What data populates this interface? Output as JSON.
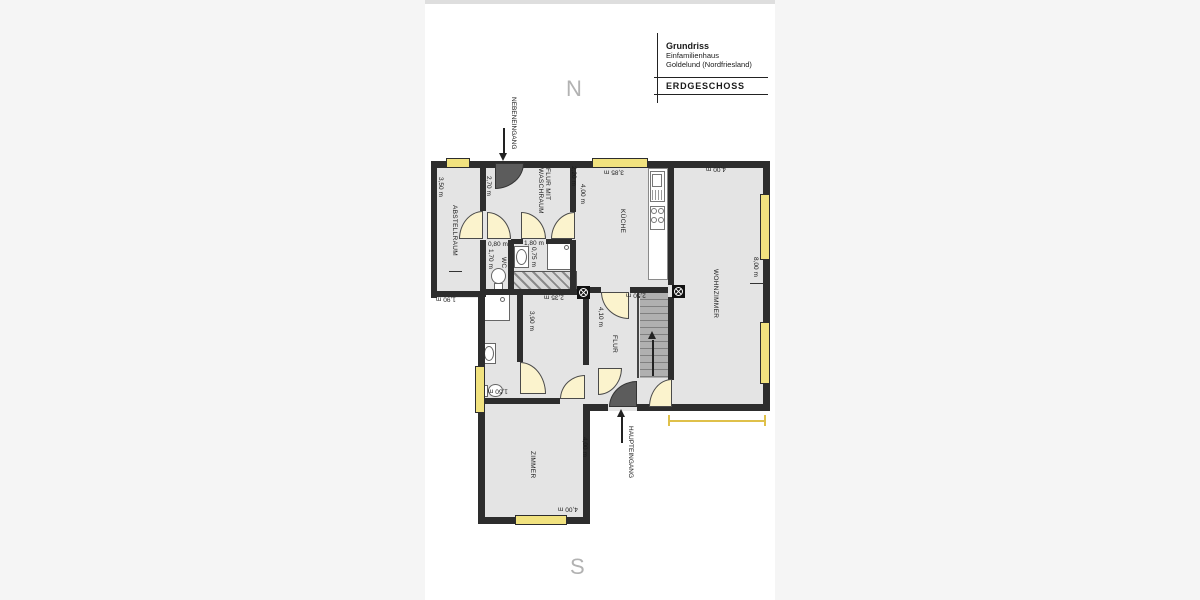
{
  "title_block": {
    "title": "Grundriss",
    "subtitle1": "Einfamilienhaus",
    "subtitle2": "Goldelund (Nordfriesland)",
    "floor_label": "ERDGESCHOSS"
  },
  "compass": {
    "north": "N",
    "south": "S"
  },
  "entrances": {
    "side_entrance": "NEBENEINGANG",
    "main_entrance": "HAUPTEINGANG"
  },
  "rooms": {
    "storage": "ABSTELLRAUM",
    "hall_laundry_line1": "FLUR MIT",
    "hall_laundry_line2": "WASCHRAUM",
    "wc": "WC",
    "kitchen": "KÜCHE",
    "living_room": "WOHNZIMMER",
    "hallway": "FLUR",
    "room": "ZIMMER"
  },
  "dimensions": {
    "storage_height": "3,50 m",
    "hall_left": "2,70 m",
    "hall_right": "2,20 m",
    "kitchen_left": "4,00 m",
    "kitchen_top": "3,85 m",
    "living_top": "4,00 m",
    "living_right": "8,00 m",
    "wc_width": "0,80 m",
    "wc_height": "1,70 m",
    "washroom_width": "1,80 m",
    "washroom_height": "0,75 m",
    "storage_bottom": "1,90 m",
    "midroom_width": "2,35 m",
    "midroom_height": "3,90 m",
    "stairhall_top": "2,50 m",
    "stairhall_height": "4,10 m",
    "bath_door": "1,50 m",
    "room_right": "4,00 m",
    "room_bottom": "4,00 m"
  },
  "colors": {
    "wall": "#2d2d2d",
    "floor": "#e4e4e4",
    "window": "#f1e27f",
    "door": "#fbf3cd",
    "entrance_door": "#5c5c5c",
    "stairs": "#ababab",
    "accent_line": "#dfc04a"
  }
}
